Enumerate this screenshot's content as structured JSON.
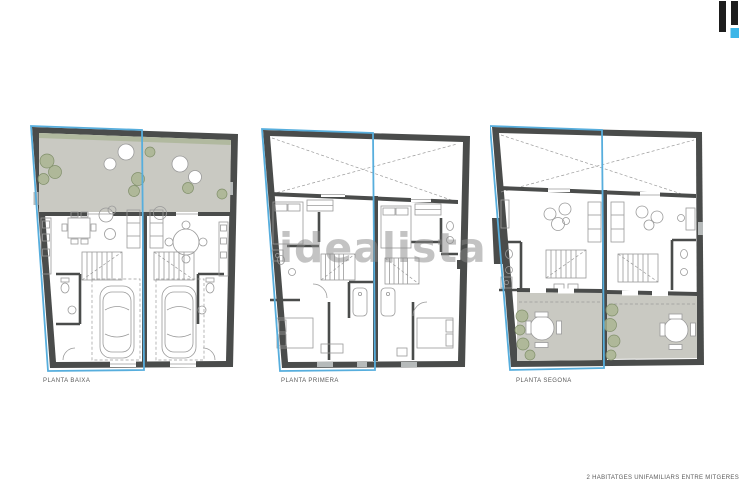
{
  "logo": {
    "name": "idealista-logo-mark"
  },
  "watermark": {
    "text": "idealista"
  },
  "plans": [
    {
      "label": "PLANTA BAIXA"
    },
    {
      "label": "PLANTA PRIMERA"
    },
    {
      "label": "PLANTA SEGONA"
    }
  ],
  "footer": {
    "caption": "2 HABITATGES UNIFAMILIARS ENTRE MITGERES"
  },
  "colors": {
    "wall": "#4a4c4b",
    "terrace": "#c9c9c2",
    "line": "#9a9a9a",
    "veg": "#a9b48e",
    "vegstroke": "#81906b",
    "hedge": "#9cab84",
    "highlight": "#57aedd",
    "logoBar": "#1d1d1d",
    "logoAccent": "#3cb6e8",
    "ink": "#5a5a5a",
    "watermark": "rgba(135,135,135,0.5)"
  }
}
